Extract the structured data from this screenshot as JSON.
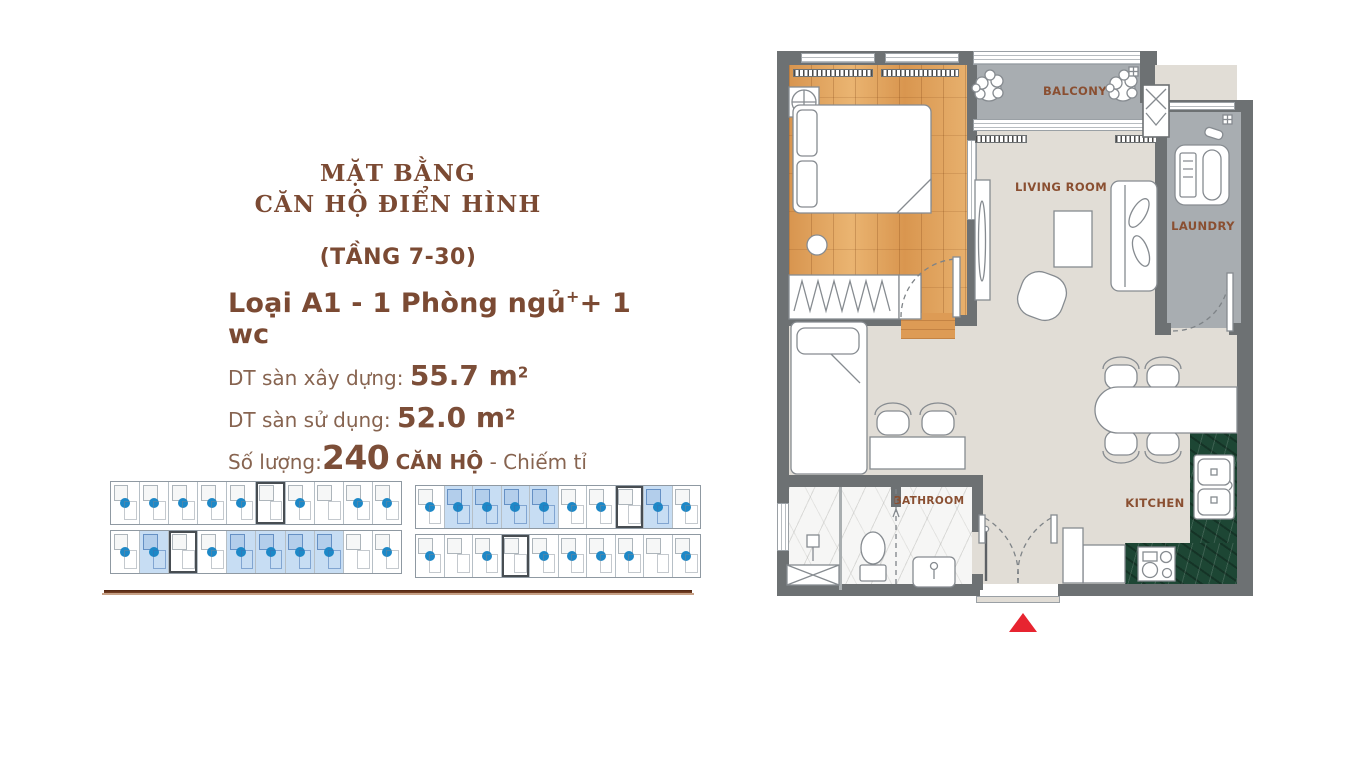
{
  "info": {
    "title_line1": "MẶT BẰNG",
    "title_line2": "CĂN HỘ ĐIỂN HÌNH",
    "floors": "(TẦNG 7-30)",
    "unit_type": "Loại A1 - 1 Phòng ngủ",
    "unit_type_sup": "+",
    "unit_type_rest": "+ 1 wc",
    "gross_label": "DT sàn xây dựng:",
    "gross_value": "55.7 m",
    "gross_sup": "2",
    "net_label": "DT sàn sử dụng:",
    "net_value": "52.0 m",
    "net_sup": "2",
    "qty_label": "Số lượng:",
    "qty_value": "240",
    "qty_unit": "CĂN HỘ",
    "ratio_label": "- Chiếm tỉ lệ:",
    "ratio_value": "30",
    "ratio_sup": "%"
  },
  "plan": {
    "rooms": {
      "master_bedroom": "MASTER BEDROOM",
      "balcony": "BALCONY",
      "living_room": "LIVING ROOM",
      "laundry": "LAUNDRY",
      "bedroom": "BEDROOM",
      "bathroom": "BATHROOM",
      "kitchen": "KITCHEN"
    },
    "entrance_marker": "entrance-arrow"
  },
  "site_plans": {
    "wings": [
      {
        "strips": [
          {
            "units": 10,
            "highlighted": [],
            "core": [
              5
            ],
            "dots": [
              0,
              1,
              2,
              3,
              4,
              6,
              8,
              9
            ]
          },
          {
            "units": 10,
            "highlighted": [
              1,
              4,
              5,
              6,
              7
            ],
            "core": [
              2
            ],
            "dots": [
              0,
              1,
              3,
              4,
              5,
              6,
              7,
              9
            ]
          }
        ]
      },
      {
        "strips": [
          {
            "units": 10,
            "highlighted": [
              1,
              2,
              3,
              4,
              8
            ],
            "core": [
              7
            ],
            "dots": [
              0,
              1,
              2,
              3,
              4,
              5,
              6,
              8,
              9
            ]
          },
          {
            "units": 10,
            "highlighted": [],
            "core": [
              3
            ],
            "dots": [
              0,
              2,
              4,
              5,
              6,
              7,
              9
            ]
          }
        ]
      }
    ]
  },
  "colors": {
    "accent_brown": "#7b4a33",
    "text_brown": "#85604e",
    "wall_gray": "#6d7173",
    "floor_beige": "#e1ddd6",
    "wood": "#dd9b55",
    "balcony_gray": "#a8adb1",
    "kitchen_green": "#1d4634",
    "marble_white": "#f6f6f5",
    "highlight_blue": "#c7ddf3",
    "marker_blue": "#1d88c7",
    "entrance_red": "#e72430",
    "divider_brown": "#4f2410"
  }
}
